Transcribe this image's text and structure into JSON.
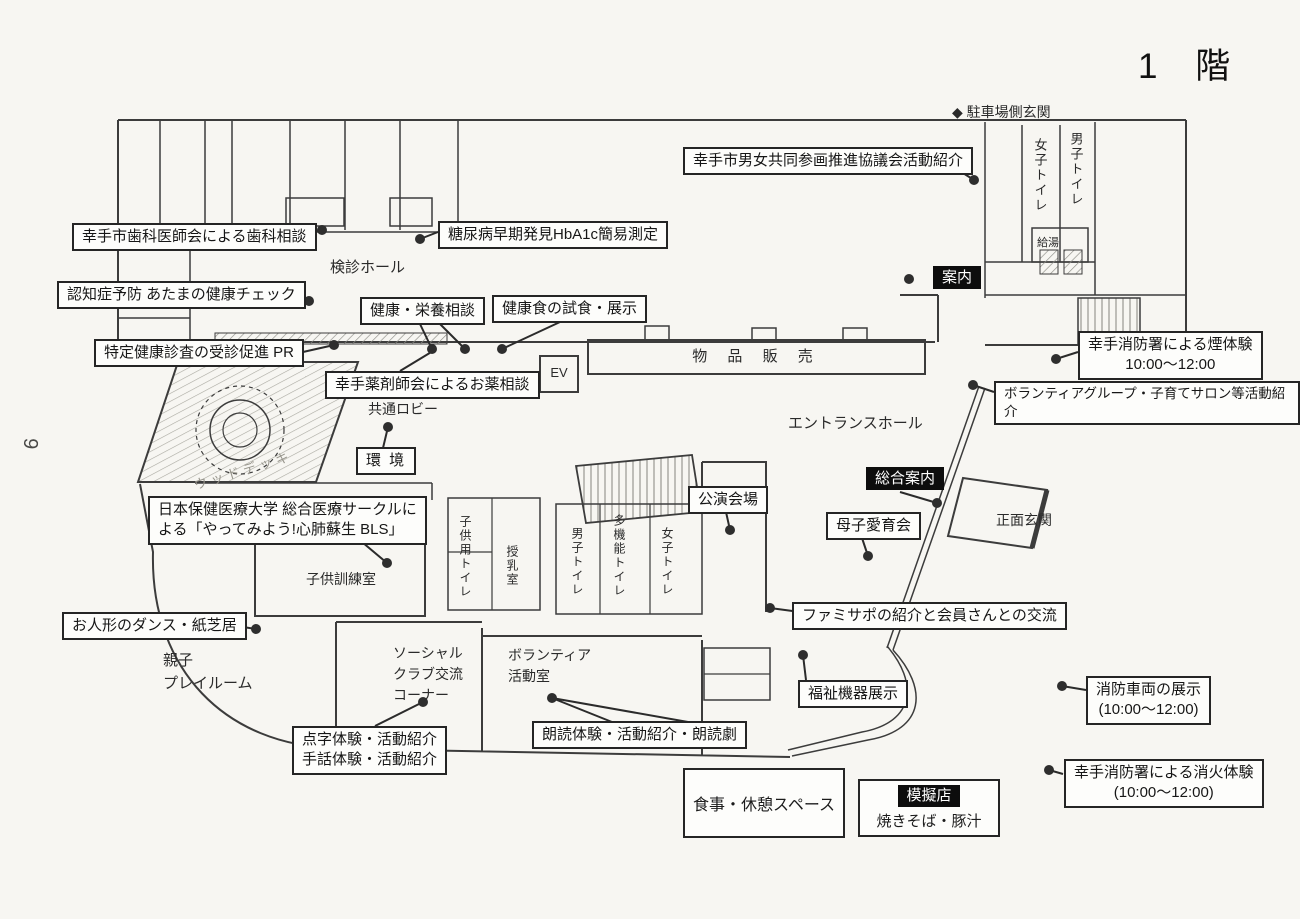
{
  "page": {
    "title": "1 階",
    "side_number": "9"
  },
  "colors": {
    "ink": "#2b2b2b",
    "paper": "#f7f6f2",
    "badge_bg": "#0d0d0d",
    "badge_text": "#ffffff"
  },
  "entrances": {
    "parking": "◆ 駐車場側玄関",
    "front": "正面玄関"
  },
  "rooms": {
    "kenshin_hall": "検診ホール",
    "kyotsu_lobby": "共通ロビー",
    "entrance_hall": "エントランスホール",
    "buppin_hanbai": "物 品 販 売",
    "ev": "EV",
    "wood_deck": "ウッドデッキ",
    "kodomo_kunren": "子供訓練室",
    "oyako_playroom": "親子\nプレイルーム",
    "social_club": "ソーシャル\nクラブ交流\nコーナー",
    "volunteer_room": "ボランティア\n活動室",
    "kyuto": "給湯",
    "toilet_w_top": "女子トイレ",
    "toilet_m_top": "男子トイレ",
    "toilet_kids": "子供用トイレ",
    "junyu_room": "授乳室",
    "toilet_m_mid": "男子トイレ",
    "toilet_multi": "多機能トイレ",
    "toilet_w_mid": "女子トイレ"
  },
  "badges": {
    "annai": "案内",
    "sogo_annai": "総合案内",
    "mogiten": "模擬店"
  },
  "callouts": {
    "danjo": "幸手市男女共同参画推進協議会活動紹介",
    "shika": "幸手市歯科医師会による歯科相談",
    "tonyo": "糖尿病早期発見HbA1c簡易測定",
    "ninchi": "認知症予防 あたまの健康チェック",
    "kenko_eiyo": "健康・栄養相談",
    "kenkoshoku": "健康食の試食・展示",
    "tokutei": "特定健康診査の受診促進 PR",
    "yakuzai": "幸手薬剤師会によるお薬相談",
    "kemuri": "幸手消防署による煙体験\n10:00〜12:00",
    "volunteer_group": "ボランティアグループ・子育てサロン等活動紹介",
    "kankyo": "環 境",
    "koen_kaijo": "公演会場",
    "boshi": "母子愛育会",
    "bls": "日本保健医療大学 総合医療サークルに\nよる「やってみよう!心肺蘇生 BLS」",
    "famisapo": "ファミサポの紹介と会員さんとの交流",
    "oningyo": "お人形のダンス・紙芝居",
    "fukushi": "福祉機器展示",
    "tenji": "点字体験・活動紹介\n手話体験・活動紹介",
    "rodoku": "朗読体験・活動紹介・朗読劇",
    "shobo_sharyo": "消防車両の展示\n(10:00〜12:00)",
    "shoka": "幸手消防署による消火体験\n(10:00〜12:00)",
    "shokuji": "食事・休憩スペース",
    "yakisoba": "焼きそば・豚汁"
  }
}
